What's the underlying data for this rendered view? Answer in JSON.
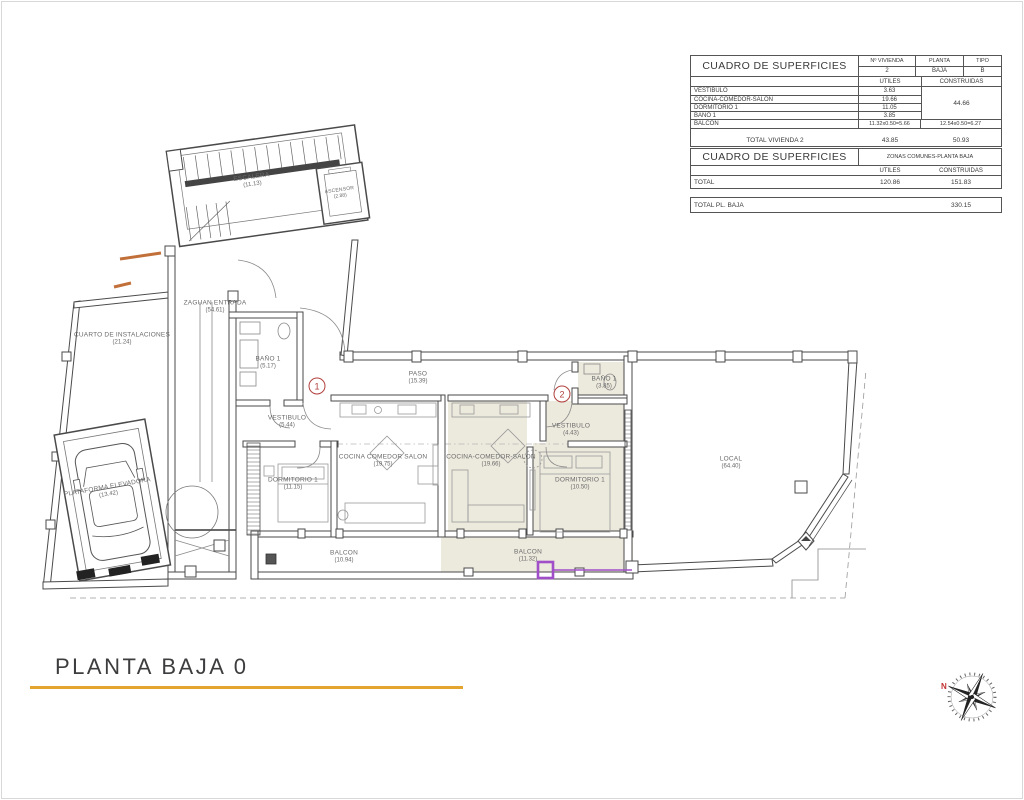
{
  "title": {
    "text": "PLANTA BAJA 0"
  },
  "colors": {
    "accent_gold": "#e3a52f",
    "marker_red": "#b0403c",
    "highlight_purple": "#a04fc8",
    "apartment_shade": "#ece9dd",
    "step_orange": "#c2703a",
    "wall": "#4a4a4a"
  },
  "tables": {
    "vivienda": {
      "title": "CUADRO DE SUPERFICIES",
      "header": {
        "vivienda_label": "Nº VIVIENDA",
        "vivienda_value": "2",
        "planta_label": "PLANTA",
        "planta_value": "BAJA",
        "tipo_label": "TIPO",
        "tipo_value": "B",
        "utiles": "UTILES",
        "construidas": "CONSTRUIDAS"
      },
      "rows": [
        {
          "label": "VESTIBULO",
          "utiles": "3.63"
        },
        {
          "label": "COCINA-COMEDOR-SALON",
          "utiles": "19.66"
        },
        {
          "label": "DORMITORIO 1",
          "utiles": "11.05"
        },
        {
          "label": "BAÑO 1",
          "utiles": "3.85"
        }
      ],
      "construidas_merged": "44.66",
      "balcon_row": {
        "label": "BALCON",
        "utiles": "11.32x0.50=5.66",
        "construidas": "12.54x0.50=6.27"
      },
      "total_row": {
        "label": "TOTAL VIVIENDA 2",
        "utiles": "43.85",
        "construidas": "50.93"
      }
    },
    "comunes": {
      "title": "CUADRO DE SUPERFICIES",
      "zone": "ZONAS COMUNES-PLANTA BAJA",
      "utiles": "UTILES",
      "construidas": "CONSTRUIDAS",
      "total_row": {
        "label": "TOTAL",
        "utiles": "120.86",
        "construidas": "151.83"
      },
      "grand_total": {
        "label": "TOTAL PL. BAJA",
        "value": "330.15"
      }
    }
  },
  "plan": {
    "rooms": [
      {
        "name": "ESCALERA",
        "area": "(11.13)"
      },
      {
        "name": "ASCENSOR",
        "area": "(2.88)"
      },
      {
        "name": "ZAGUAN ENTRADA",
        "area": "(54.61)"
      },
      {
        "name": "CUARTO DE INSTALACIONES",
        "area": "(21.24)"
      },
      {
        "name": "BAÑO 1",
        "area": "(5.17)"
      },
      {
        "name": "PASO",
        "area": "(15.39)"
      },
      {
        "name": "VESTIBULO",
        "area": "(5.44)"
      },
      {
        "name": "COCINA COMEDOR SALON",
        "area": "(19.75)"
      },
      {
        "name": "DORMITORIO 1",
        "area": "(11.15)"
      },
      {
        "name": "BALCON",
        "area": "(10.94)"
      },
      {
        "name": "COCINA-COMEDOR-SALON",
        "area": "(19.66)"
      },
      {
        "name": "VESTIBULO",
        "area": "(4.43)"
      },
      {
        "name": "BAÑO 1",
        "area": "(3.85)"
      },
      {
        "name": "DORMITORIO 1",
        "area": "(10.50)"
      },
      {
        "name": "BALCON",
        "area": "(11.32)"
      },
      {
        "name": "LOCAL",
        "area": "(64.40)"
      },
      {
        "name": "PLATAFORMA ELEVADORA",
        "area": "(13.42)"
      }
    ],
    "markers": {
      "apt1": "1",
      "apt2": "2"
    },
    "compass_north": "N"
  }
}
